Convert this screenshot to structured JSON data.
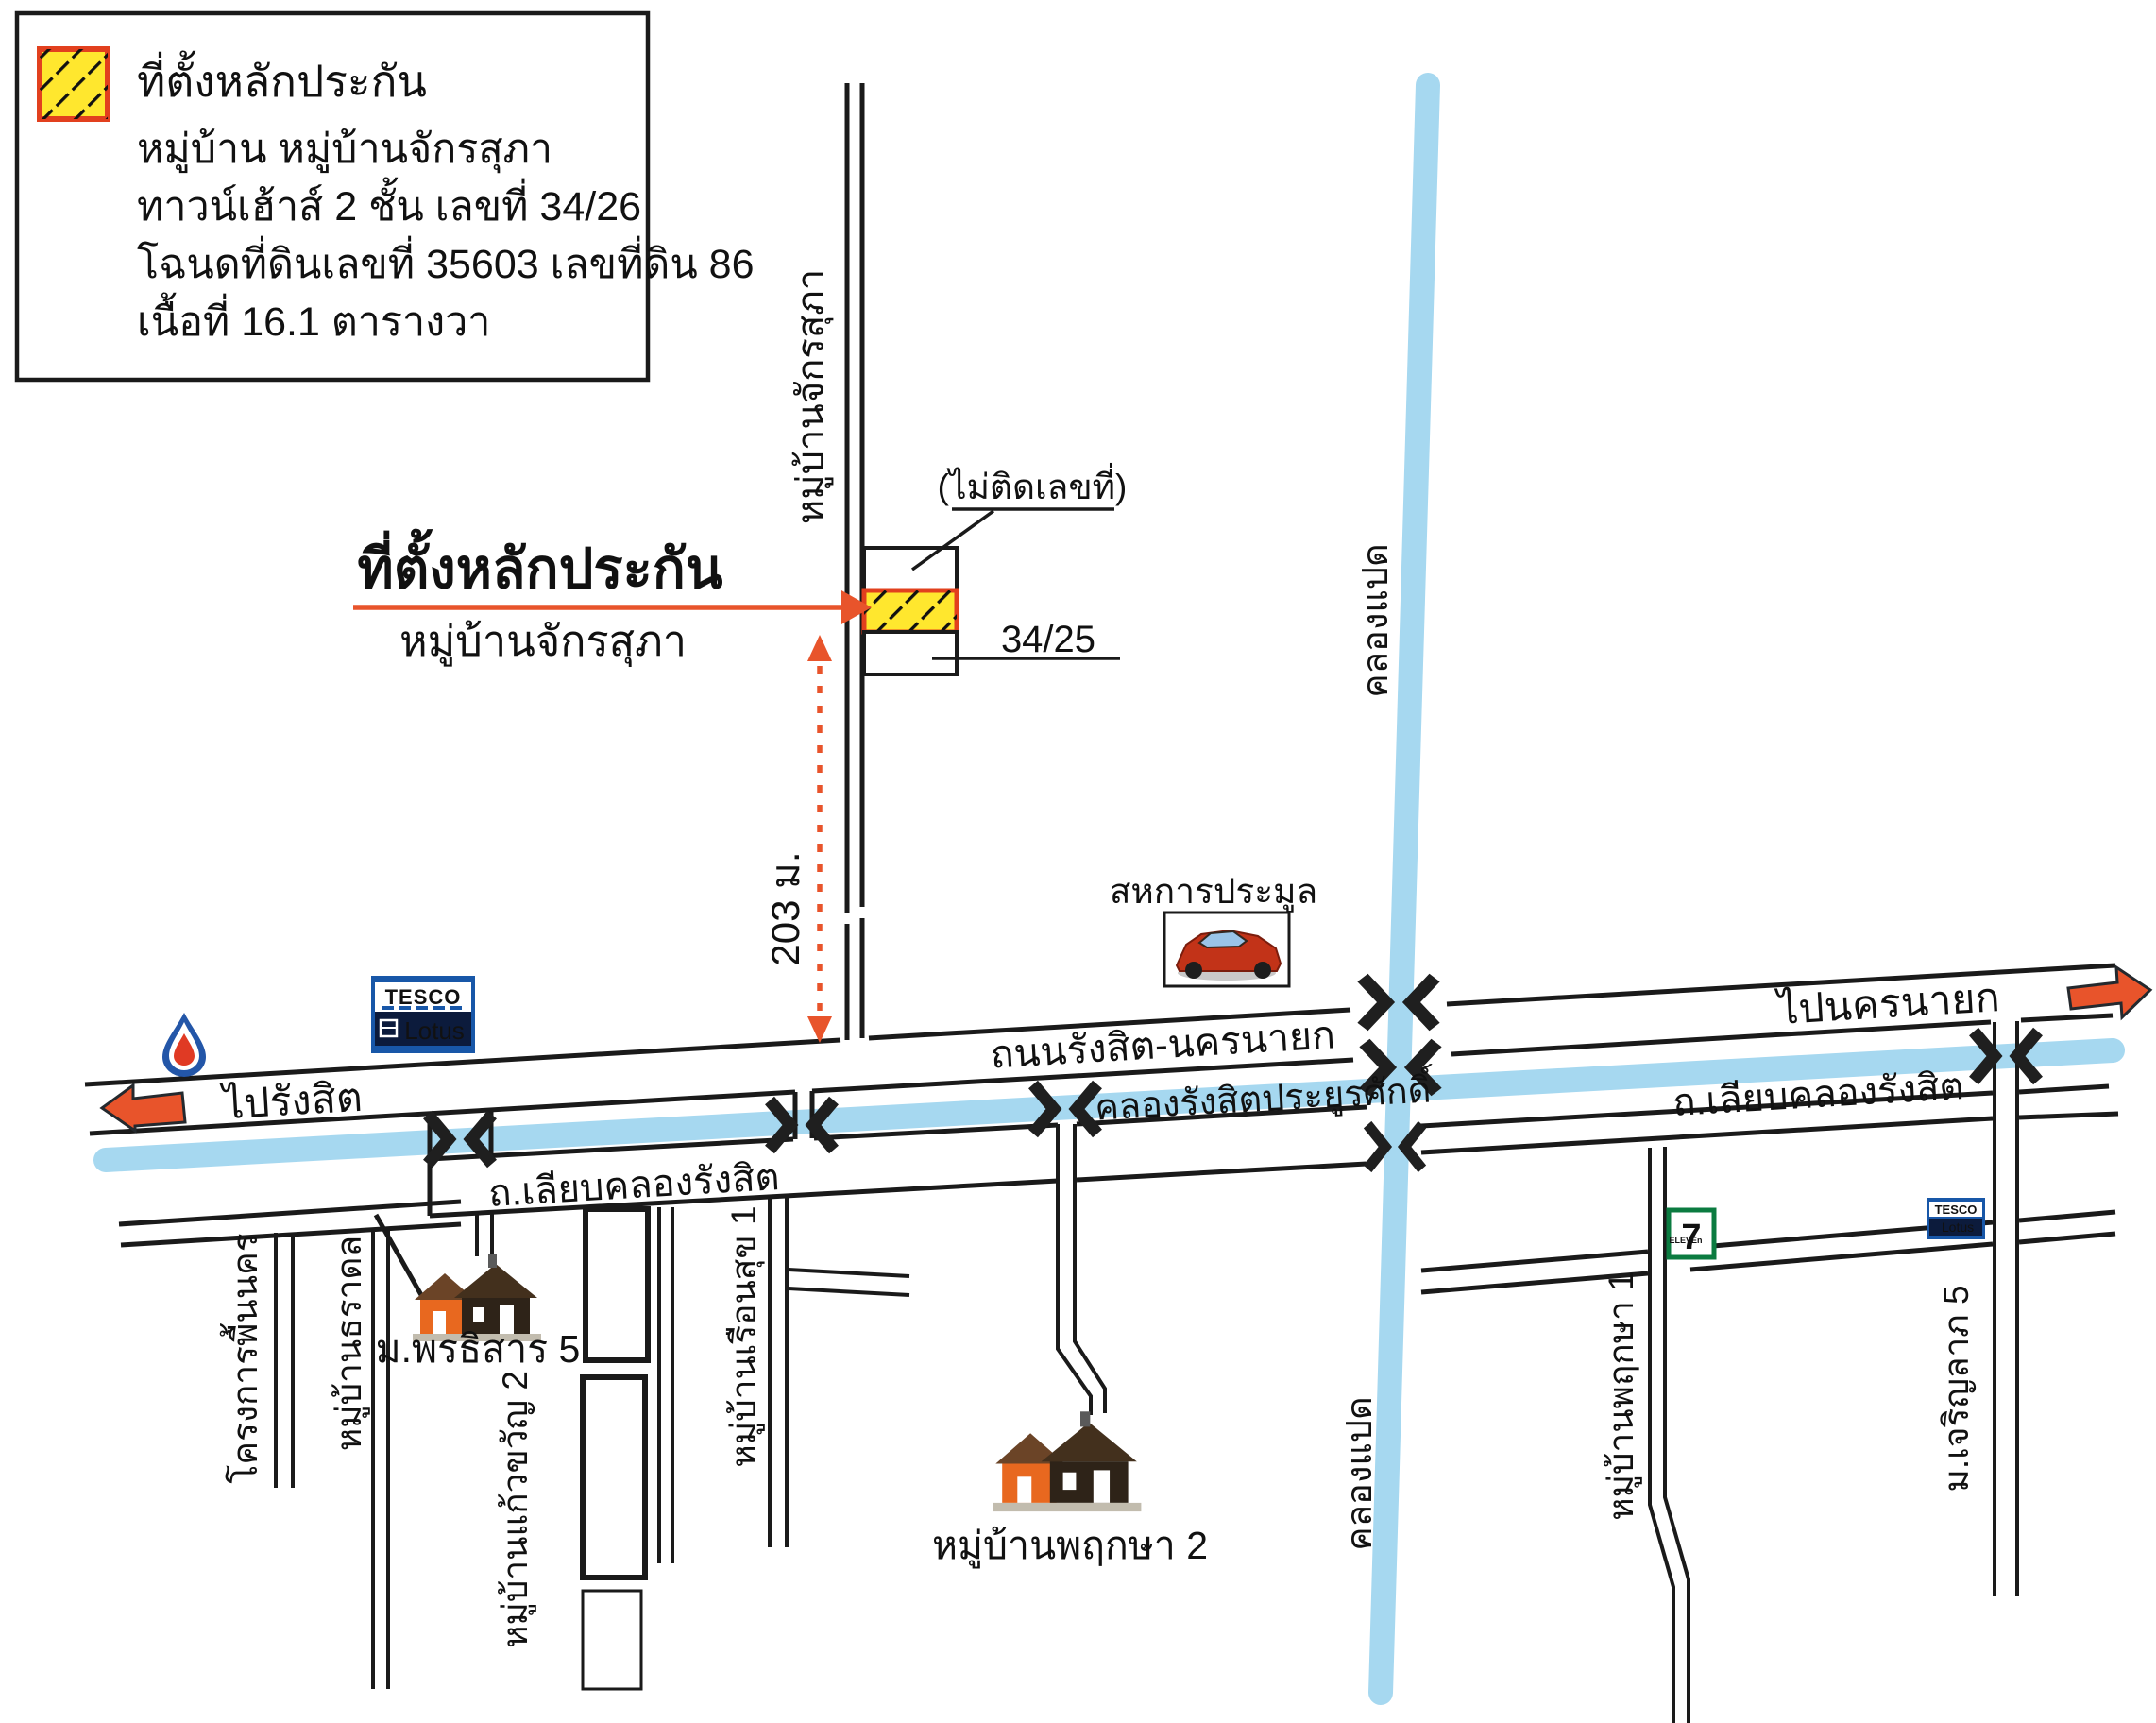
{
  "colors": {
    "accent_red": "#cf3a1d",
    "arrow_red": "#e8542b",
    "canal_blue": "#a6d8f0",
    "hatch_yellow": "#ffe72e",
    "hatch_border": "#e2401e",
    "road_black": "#1a1a1a",
    "tesco_blue": "#1857a8",
    "tesco_navy": "#0c1b3c",
    "tesco_red": "#e02a18",
    "seven_green": "#0b7b40",
    "seven_orange": "#f26822"
  },
  "legend": {
    "title": "ที่ตั้งหลักประกัน",
    "village": "หมู่บ้าน หมู่บ้านจักรสุภา",
    "house_type": "ทาวน์เฮ้าส์ 2 ชั้น เลขที่ 34/26",
    "deed": "โฉนดที่ดินเลขที่ 35603 เลขที่ดิน 86",
    "area": "เนื้อที่ 16.1 ตารางวา"
  },
  "callout": {
    "title": "ที่ตั้งหลักประกัน",
    "village": "หมู่บ้านจักรสุภา",
    "no_house_number": "(ไม่ติดเลขที่)",
    "neighbor_number": "34/25",
    "distance": "203 ม."
  },
  "roads": {
    "soi": "หมู่บ้านจักรสุภา",
    "main": "ถนนรังสิต-นครนายก",
    "to_west": "ไปรังสิต",
    "to_east": "ไปนครนายก",
    "liab_west": "ถ.เลียบคลองรังสิต",
    "liab_east": "ถ.เลียบคลองรังสิต"
  },
  "canals": {
    "rangsit": "คลองรังสิตประยูรศักดิ์",
    "klong8": "คลองแปด",
    "klong8_south": "คลองแปด"
  },
  "places": {
    "auction": "สหการประมูล",
    "tesco_line1": "TESCO",
    "tesco_line2": "Lotus",
    "seven_digit": "7",
    "seven_word": "ELEVEn",
    "pornthisan": "ม.พรธิสาร 5",
    "pruksa2": "หมู่บ้านพฤกษา 2",
    "pruksa1": "หมู่บ้านพฤกษา 1",
    "charoenlap": "ม.เจริญลาภ 5",
    "kaewkwan": "หมู่บ้านแก้วขวัญ 2",
    "ruansuk": "หมู่บ้านเรือนสุข 1",
    "tharadol": "หมู่บ้านธราดล",
    "phuennakorn": "โครงการพื้นนคร"
  }
}
